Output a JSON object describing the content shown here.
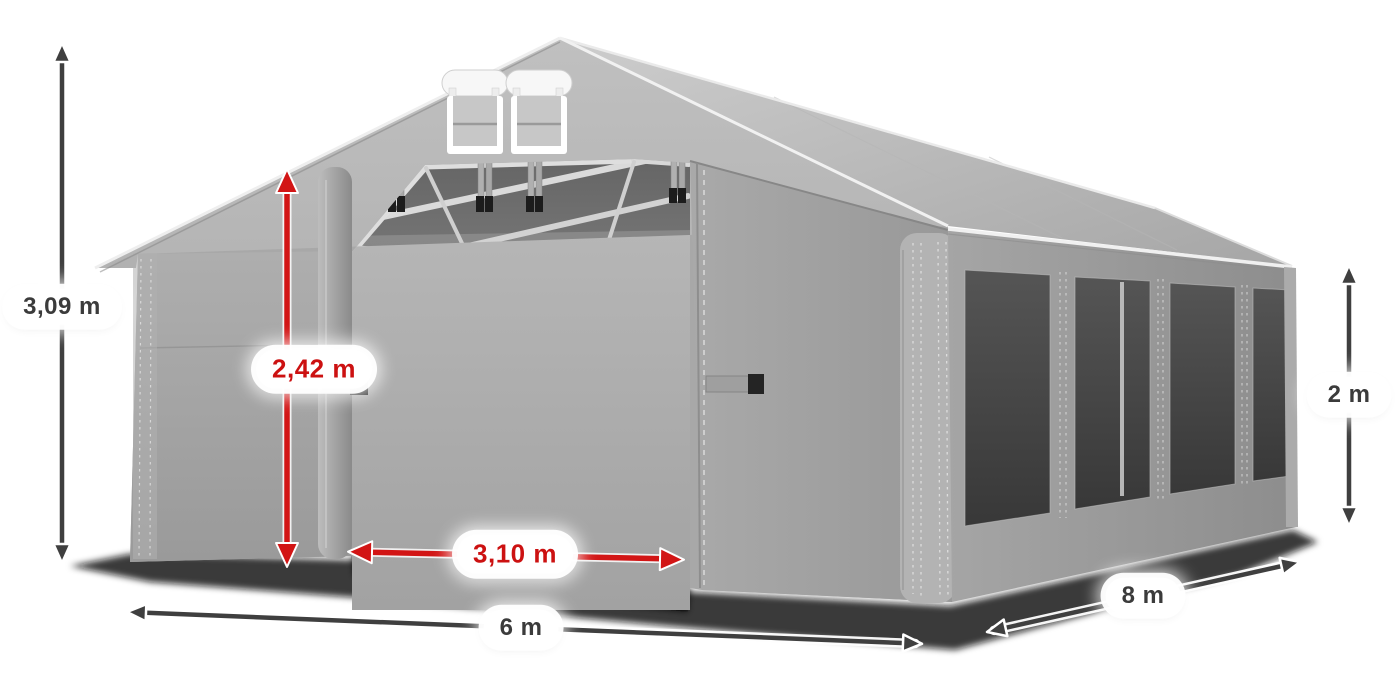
{
  "dimensions": {
    "total_height": {
      "text": "3,09 m",
      "style": "dark"
    },
    "entrance_height": {
      "text": "2,42 m",
      "style": "red"
    },
    "entrance_width": {
      "text": "3,10 m",
      "style": "red"
    },
    "front_width": {
      "text": "6 m",
      "style": "dark"
    },
    "side_length": {
      "text": "8 m",
      "style": "dark"
    },
    "side_wall_height": {
      "text": "2 m",
      "style": "dark"
    }
  },
  "colors": {
    "dimension_arrow_dark": "#3f3f3f",
    "dimension_arrow_red": "#d21515",
    "label_background": "#ffffff",
    "label_text_dark": "#3b3b3b",
    "label_text_red": "#cc1111",
    "tent_fabric_light": "#b5b5b5",
    "tent_fabric_mid": "#a3a3a3",
    "tent_interior_dark": "#6c6c6c",
    "window_mesh_dark": "#474747",
    "background": "#ffffff"
  }
}
